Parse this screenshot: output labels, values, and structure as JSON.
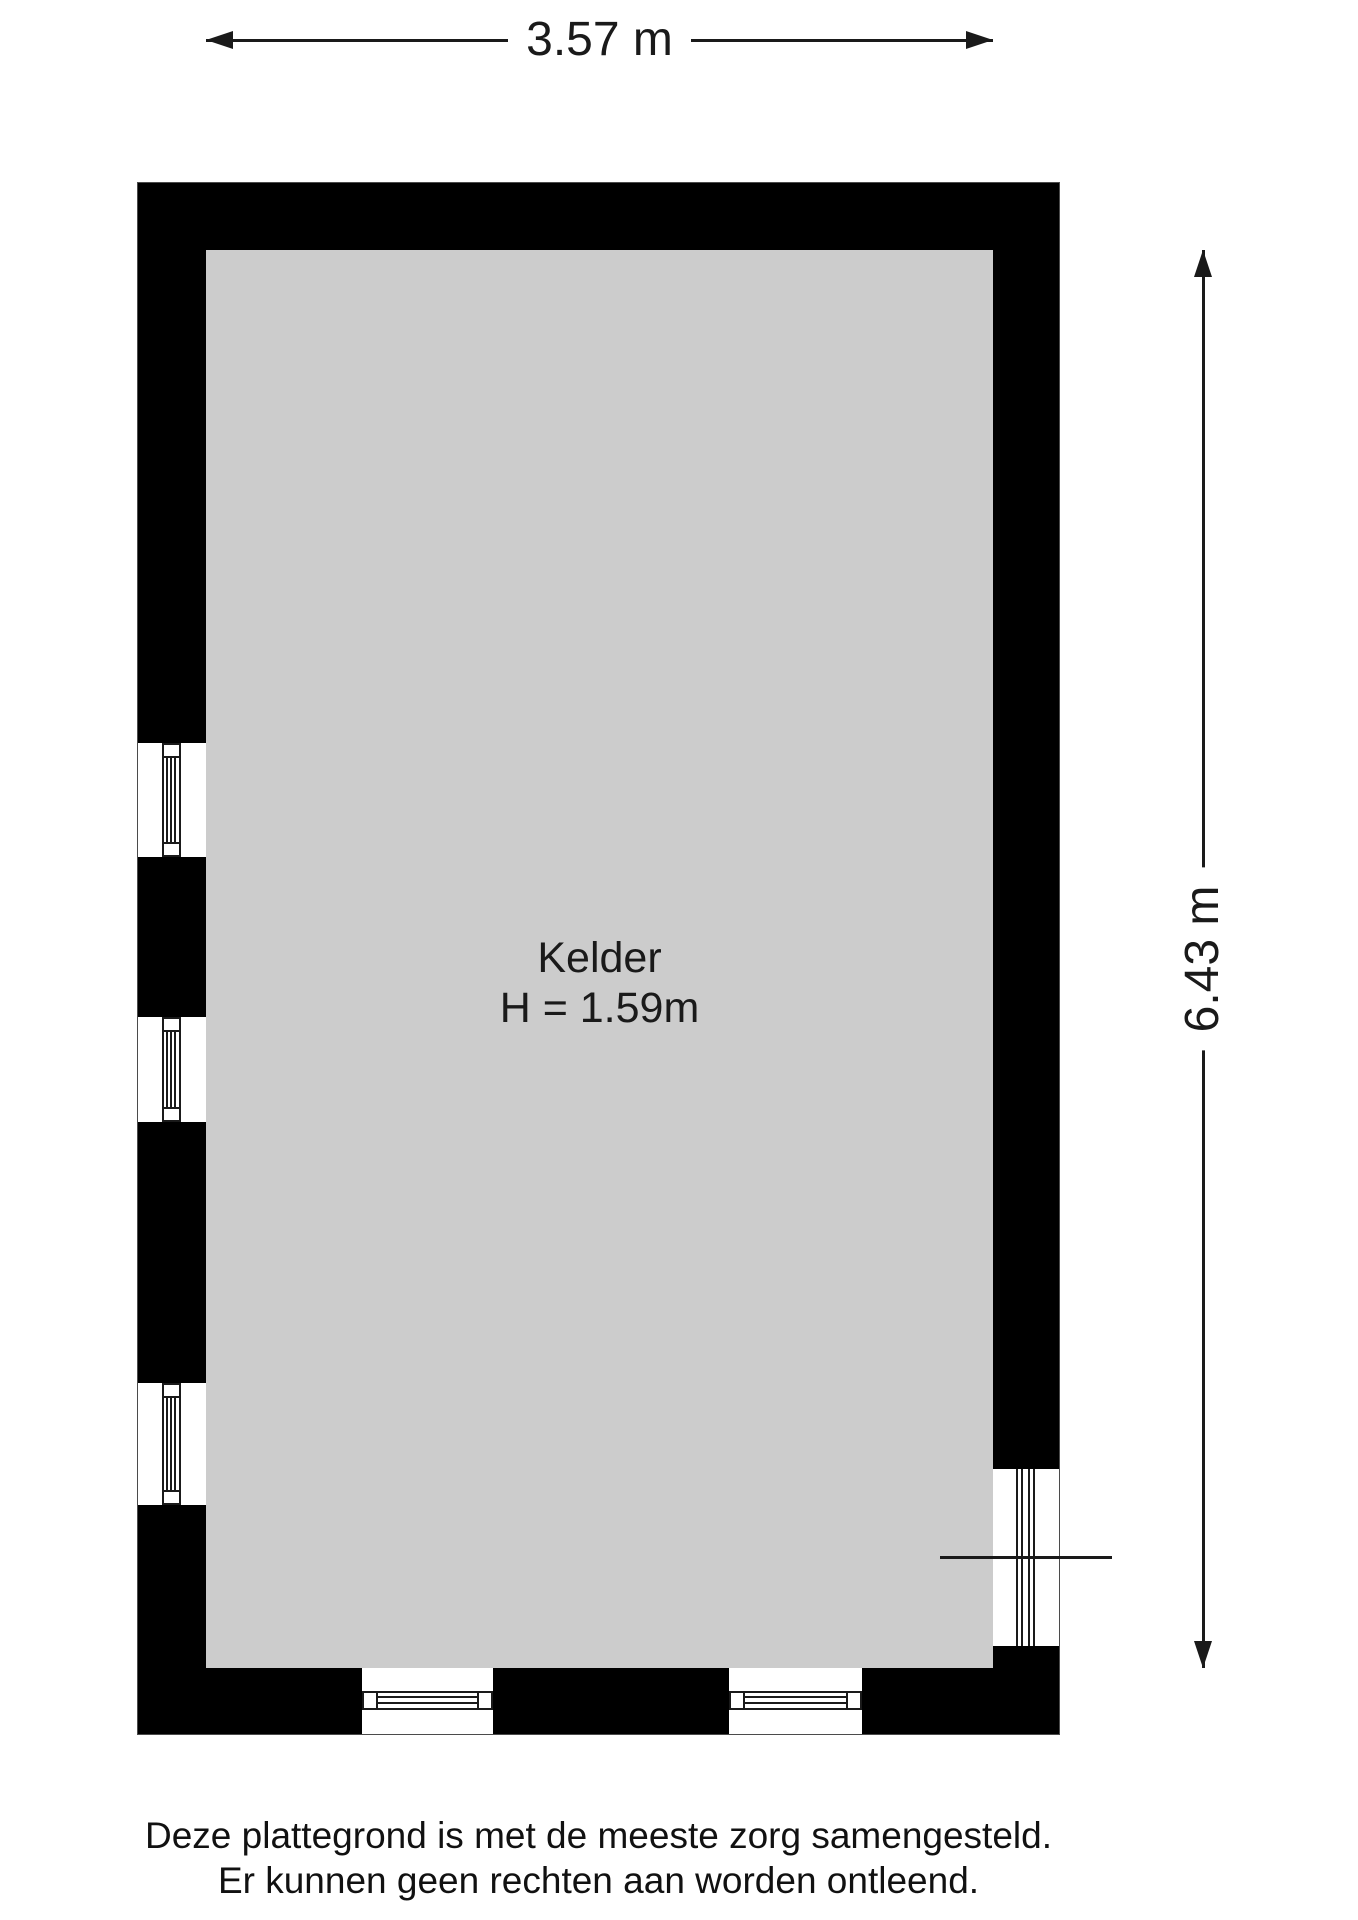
{
  "dimensions": {
    "width": "3.57 m",
    "height": "6.43 m"
  },
  "room": {
    "name": "Kelder",
    "ceiling_height": "H = 1.59m"
  },
  "disclaimer": {
    "line1": "Deze plattegrond is met de meeste zorg samengesteld.",
    "line2": "Er kunnen geen rechten aan worden ontleend."
  },
  "features": {
    "left_windows": 3,
    "bottom_windows": 2,
    "right_door_openings": 1
  },
  "colors": {
    "wall": "#000000",
    "floor": "#cccccc",
    "background": "#ffffff",
    "line": "#1a1a1a"
  }
}
